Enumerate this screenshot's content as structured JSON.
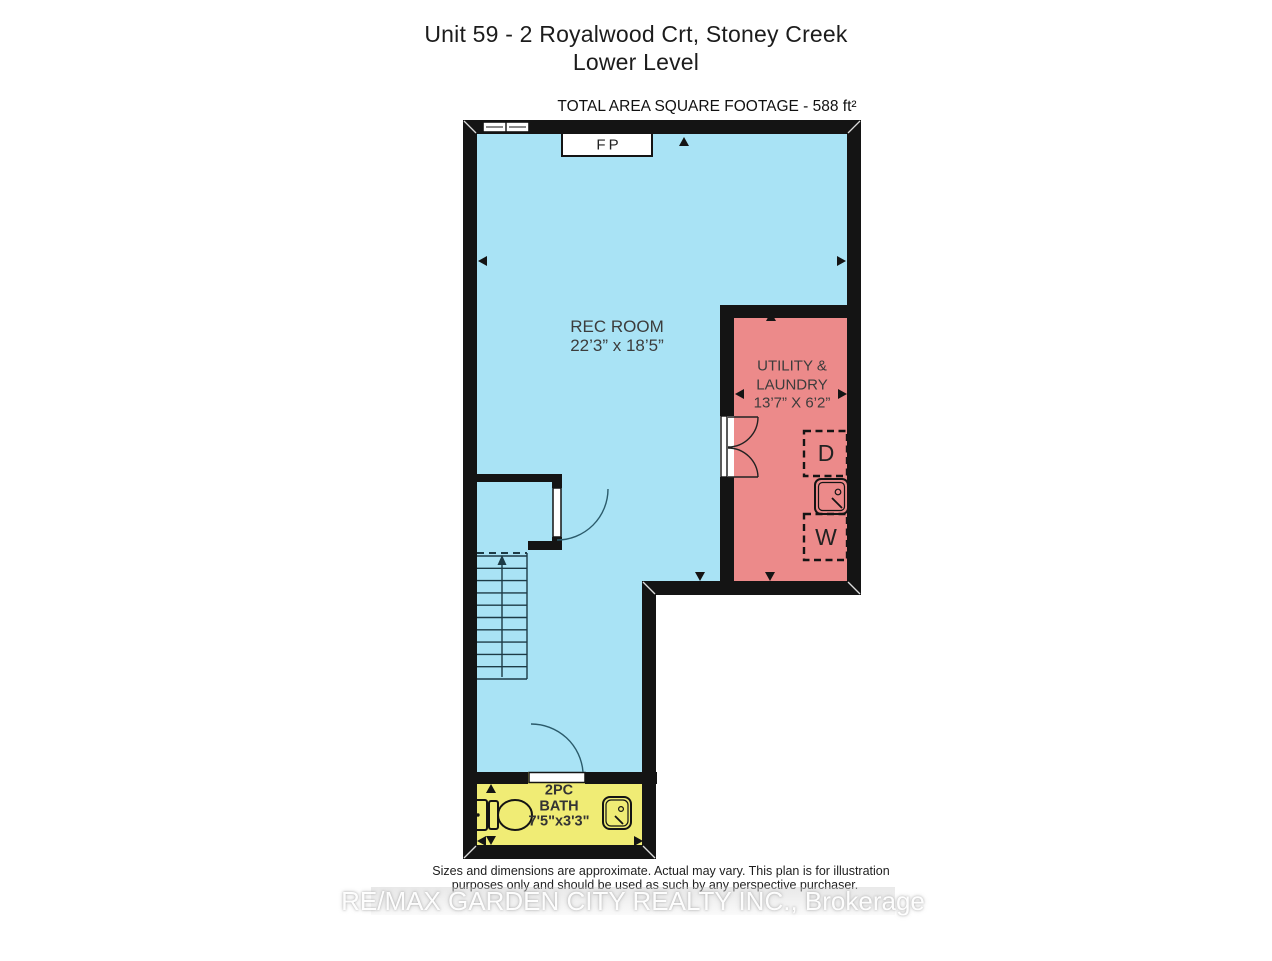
{
  "header": {
    "title_line1": "Unit 59 - 2 Royalwood Crt, Stoney Creek",
    "title_line2": "Lower Level",
    "area_label": "TOTAL AREA SQUARE FOOTAGE - 588 ft²"
  },
  "plan": {
    "rec_room": {
      "name": "REC ROOM",
      "dims": "22’3” x 18’5”"
    },
    "utility": {
      "name_line1": "UTILITY &",
      "name_line2": "LAUNDRY",
      "dims": "13’7” X 6’2”"
    },
    "bath": {
      "name_line1": "2PC",
      "name_line2": "BATH",
      "dims": "7'5\"x3'3\""
    },
    "fireplace_label": "FP",
    "dryer_label": "D",
    "washer_label": "W"
  },
  "colors": {
    "wall": "#141414",
    "rec_room_fill": "#a9e3f5",
    "utility_fill": "#ec8a8a",
    "bath_fill": "#f0ec75",
    "label_text": "#3c3c3c"
  },
  "footer": {
    "disclaimer_line1": "Sizes and dimensions are approximate. Actual may vary. This plan is for illustration",
    "disclaimer_line2": "purposes only and should be used as such by any perspective purchaser.",
    "watermark": "RE/MAX GARDEN CITY REALTY INC., Brokerage"
  }
}
